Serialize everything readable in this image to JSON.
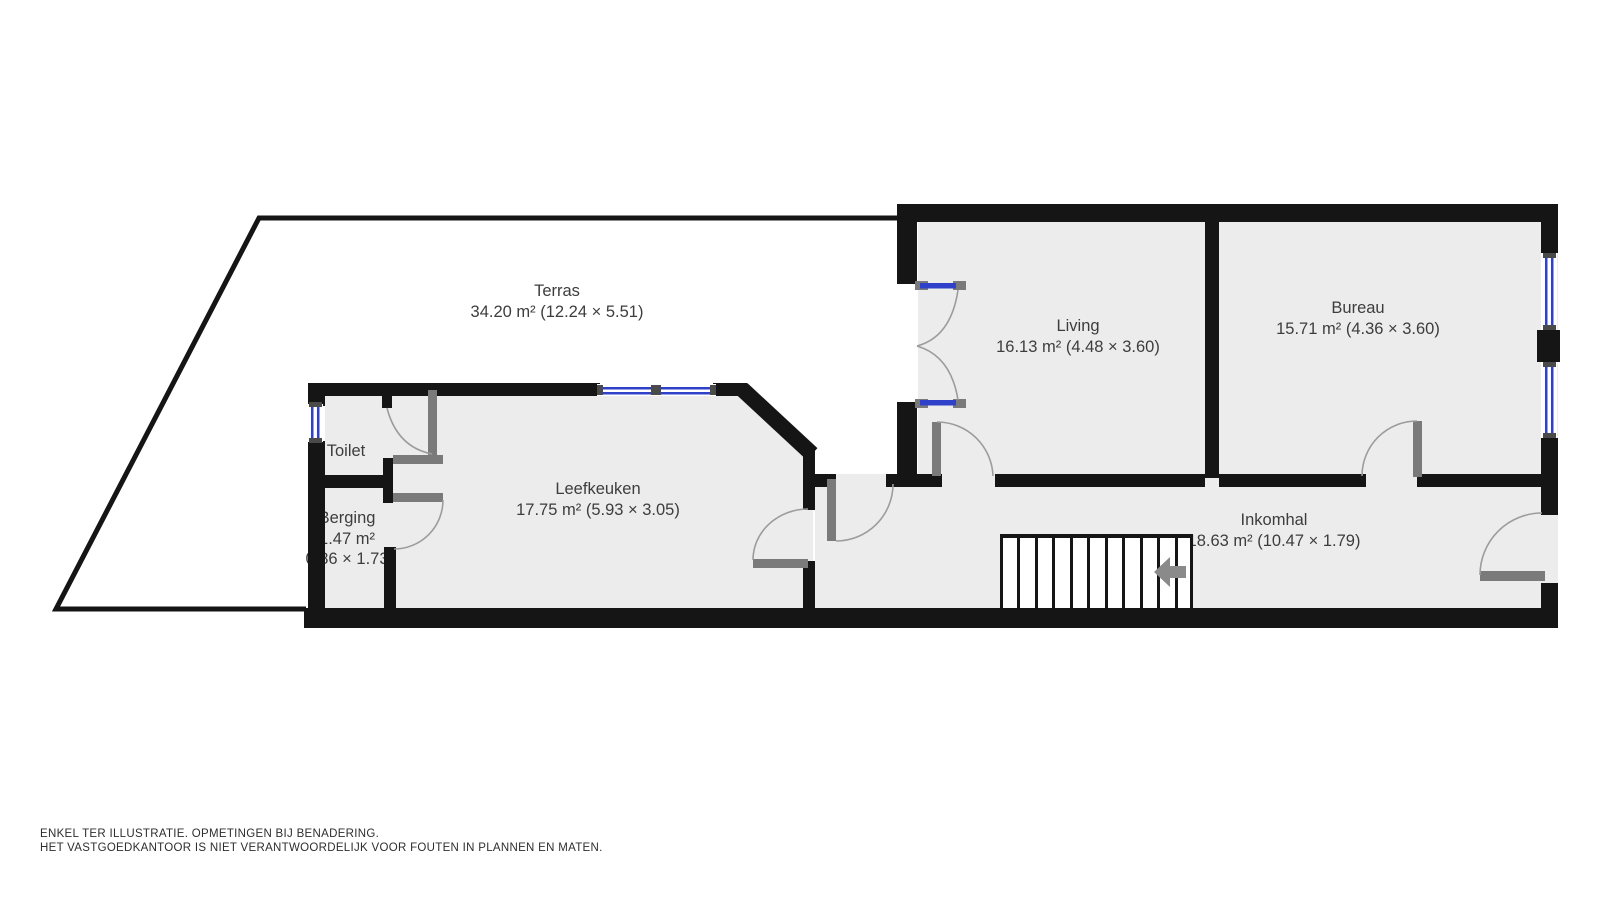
{
  "floorplan": {
    "rooms": [
      {
        "id": "terras",
        "name": "Terras",
        "size_label": "34.20 m² (12.24 × 5.51)"
      },
      {
        "id": "living",
        "name": "Living",
        "size_label": "16.13 m² (4.48 × 3.60)"
      },
      {
        "id": "bureau",
        "name": "Bureau",
        "size_label": "15.71 m² (4.36 × 3.60)"
      },
      {
        "id": "leefkeuken",
        "name": "Leefkeuken",
        "size_label": "17.75 m² (5.93 × 3.05)"
      },
      {
        "id": "inkomhal",
        "name": "Inkomhal",
        "size_label": "18.63 m² (10.47 × 1.79)"
      },
      {
        "id": "toilet",
        "name": "Toilet"
      },
      {
        "id": "berging",
        "name": "Berging",
        "size_label": "1.47 m²",
        "dims_label": "0.86 × 1.73"
      }
    ],
    "disclaimer": {
      "line1": "ENKEL TER ILLUSTRATIE. OPMETINGEN BIJ BENADERING.",
      "line2": "HET VASTGOEDKANTOOR IS NIET VERANTWOORDELIJK VOOR FOUTEN IN PLANNEN EN MATEN."
    },
    "colors": {
      "wall": "#151515",
      "room_fill": "#ececec",
      "window_blue": "#2f41c9",
      "door_gray": "#7a7a7a",
      "swing_arc_gray": "#9c9c9c",
      "label_text": "#3d3d3d",
      "stairs_arrow_gray": "#8a8a8a"
    }
  }
}
